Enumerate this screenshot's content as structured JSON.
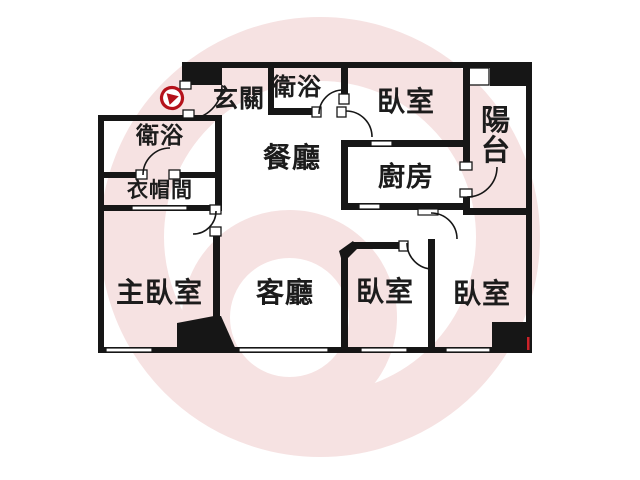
{
  "title": "apartment-floor-plan",
  "rooms": {
    "entry": {
      "label": "玄關"
    },
    "bath_top": {
      "label": "衛浴"
    },
    "bedroom_top": {
      "label": "臥室"
    },
    "balcony": {
      "label": "陽台"
    },
    "bath_left": {
      "label": "衛浴"
    },
    "closet": {
      "label": "衣帽間"
    },
    "dining": {
      "label": "餐廳"
    },
    "kitchen": {
      "label": "廚房"
    },
    "master_bedroom": {
      "label": "主臥室"
    },
    "living": {
      "label": "客廳"
    },
    "bedroom_mid": {
      "label": "臥室"
    },
    "bedroom_right": {
      "label": "臥室"
    }
  },
  "marker": {
    "name": "entrance-view-marker",
    "shape": "play-arrow-in-circle",
    "color": "#b5121b"
  },
  "colors": {
    "wall": "#161616",
    "watermark": "#f6e2e2",
    "background": "#ffffff",
    "label": "#1c1c1c",
    "marker": "#b5121b"
  }
}
